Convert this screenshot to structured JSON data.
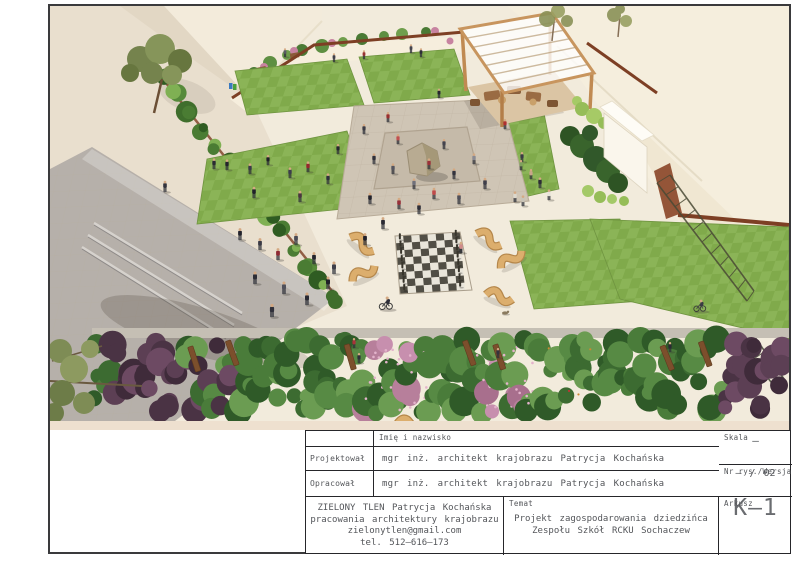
{
  "title_block": {
    "header": {
      "name_col": "Imię i nazwisko"
    },
    "rows": [
      {
        "label": "Projektował",
        "value": "mgr inż. architekt krajobrazu Patrycja Kochańska"
      },
      {
        "label": "Opracował",
        "value": "mgr inż. architekt krajobrazu Patrycja Kochańska"
      }
    ],
    "scale": {
      "label": "Skala",
      "value": "–"
    },
    "drawing_no": {
      "label": "Nr rys./Wersja",
      "value": "– / 02"
    },
    "company": {
      "lines": [
        "ZIELONY TLEN Patrycja Kochańska",
        "pracowania architektury krajobrazu",
        "zielonytlen@gmail.com",
        "tel. 512–616–173"
      ]
    },
    "subject": {
      "label": "Temat",
      "lines": [
        "Projekt zagospodarowania dziedzińca",
        "Zespołu Szkół RCKU Sochaczew"
      ]
    },
    "sheet": {
      "label": "Arkusz",
      "value": "K—1"
    }
  },
  "colors": {
    "lawn_green": "#80aa4b",
    "pavement_cream": "#f2ebdc",
    "plaza_gray": "#cfc5b5",
    "fence_rust": "#7d3f24",
    "wood_tan": "#d7a765",
    "wall_beige": "#e9dfce"
  }
}
